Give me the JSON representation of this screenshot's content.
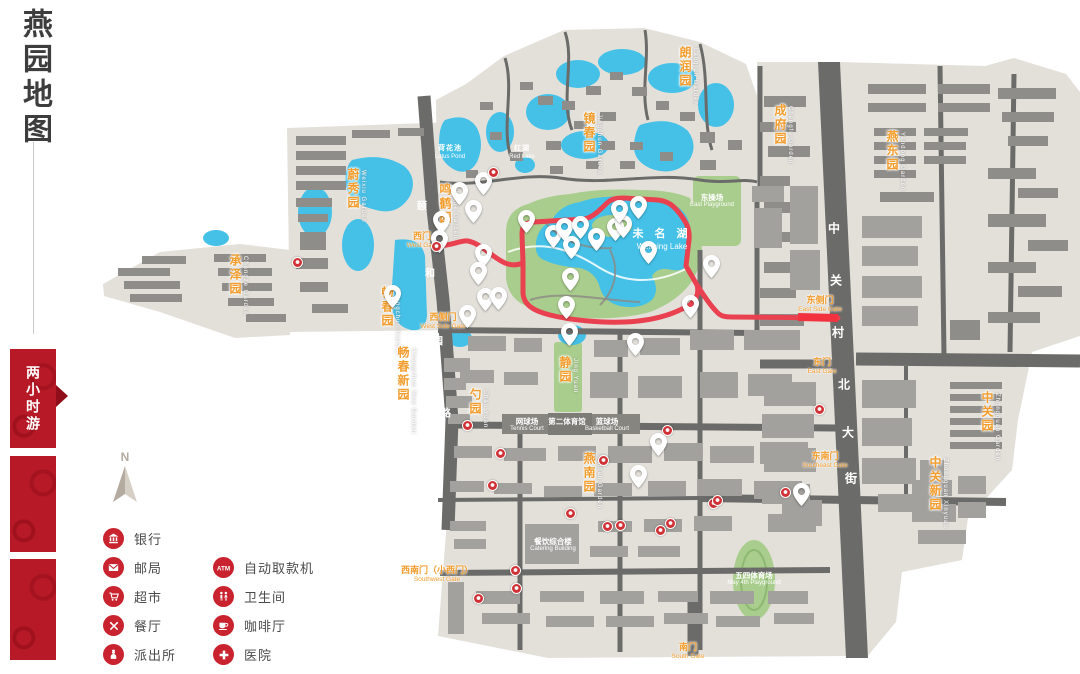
{
  "page": {
    "title": "燕园地图"
  },
  "sidebar": {
    "title": "燕园地图",
    "tour_badge": "两小时游"
  },
  "compass": {
    "label": "N"
  },
  "legend": {
    "column1": [
      {
        "icon": "bank-icon",
        "label": "银行"
      },
      {
        "icon": "post-office-icon",
        "label": "邮局"
      },
      {
        "icon": "supermarket-icon",
        "label": "超市"
      },
      {
        "icon": "restaurant-icon",
        "label": "餐厅"
      },
      {
        "icon": "police-station-icon",
        "label": "派出所"
      }
    ],
    "column2": [
      {
        "icon": "atm-icon",
        "label": "自动取款机"
      },
      {
        "icon": "toilet-icon",
        "label": "卫生间"
      },
      {
        "icon": "cafe-icon",
        "label": "咖啡厅"
      },
      {
        "icon": "hospital-icon",
        "label": "医院"
      }
    ]
  },
  "map": {
    "colors": {
      "base": "#e3e0da",
      "water": "#45c1e8",
      "green": "#a9cd8c",
      "route": "#ea4150",
      "orange": "#f29d2e",
      "road": "#6b6b69",
      "building": "#a3a19d",
      "building_dark": "#8f8d89",
      "legend_red": "#c8232e",
      "sidebar_red": "#b71a26"
    },
    "garden_labels": [
      {
        "text": "蔚秀园",
        "en": "Weixiu Garden",
        "x": 354,
        "y": 168
      },
      {
        "text": "鸣鹤园",
        "en": "Minghe Garden",
        "x": 446,
        "y": 183
      },
      {
        "text": "承泽园",
        "en": "Chengze Garden",
        "x": 236,
        "y": 254
      },
      {
        "text": "畅春园",
        "en": "Changchun Garden",
        "x": 388,
        "y": 286
      },
      {
        "text": "畅春新园",
        "en": "Changchun New Garden",
        "x": 404,
        "y": 346
      },
      {
        "text": "镜春园",
        "en": "Jingchun Garden",
        "x": 590,
        "y": 112
      },
      {
        "text": "朗润园",
        "en": "Langrun Garden",
        "x": 686,
        "y": 46
      },
      {
        "text": "成府园",
        "en": "Chengfu Garden",
        "x": 781,
        "y": 104
      },
      {
        "text": "燕东园",
        "en": "Yandong Garden",
        "x": 893,
        "y": 130
      },
      {
        "text": "中关园",
        "en": "Zhongguan Garden",
        "x": 988,
        "y": 391
      },
      {
        "text": "中关新园",
        "en": "Zhongguan Xinyuan",
        "x": 936,
        "y": 456
      },
      {
        "text": "燕南园",
        "en": "Yannan Garden",
        "x": 590,
        "y": 452
      },
      {
        "text": "静园",
        "en": "Jing Yuan",
        "x": 566,
        "y": 356
      },
      {
        "text": "勺园",
        "en": "Shao Yuan",
        "x": 476,
        "y": 388
      }
    ],
    "gate_labels": [
      {
        "text": "西门",
        "en": "West Gate",
        "x": 422,
        "y": 232
      },
      {
        "text": "西侧门",
        "en": "West Side Gate",
        "x": 443,
        "y": 313
      },
      {
        "text": "西南门（小西门）",
        "en": "Southwest Gate",
        "x": 437,
        "y": 566
      },
      {
        "text": "南门",
        "en": "South Gate",
        "x": 688,
        "y": 643
      },
      {
        "text": "东侧门",
        "en": "East Side Gate",
        "x": 820,
        "y": 296
      },
      {
        "text": "东门",
        "en": "East Gate",
        "x": 822,
        "y": 358
      },
      {
        "text": "东南门",
        "en": "Southeast Gate",
        "x": 825,
        "y": 452
      }
    ],
    "water_labels": [
      {
        "text": "未 名 湖",
        "en": "Weiming  Lake",
        "x": 662,
        "y": 228,
        "size": 11
      },
      {
        "text": "红湖",
        "en": "Red Lake",
        "x": 522,
        "y": 145,
        "size": 7
      },
      {
        "text": "荷花池",
        "en": "Lotus Pond",
        "x": 450,
        "y": 145,
        "size": 7
      }
    ],
    "area_labels": [
      {
        "text": "东操场",
        "en": "East Playground",
        "x": 712,
        "y": 193
      },
      {
        "text": "五四体育场",
        "en": "May 4th Playground",
        "x": 754,
        "y": 571
      },
      {
        "text": "网球场",
        "en": "Tennis Court",
        "x": 527,
        "y": 417
      },
      {
        "text": "第二体育馆",
        "en": "",
        "x": 567,
        "y": 417
      },
      {
        "text": "篮球场",
        "en": "Basketball Court",
        "x": 607,
        "y": 417
      },
      {
        "text": "餐饮综合楼",
        "en": "Catering Building",
        "x": 553,
        "y": 537
      }
    ],
    "street_chars": [
      {
        "ch": "中",
        "x": 834,
        "y": 228
      },
      {
        "ch": "关",
        "x": 836,
        "y": 280
      },
      {
        "ch": "村",
        "x": 838,
        "y": 332
      },
      {
        "ch": "北",
        "x": 844,
        "y": 384
      },
      {
        "ch": "大",
        "x": 848,
        "y": 432
      },
      {
        "ch": "街",
        "x": 851,
        "y": 478
      },
      {
        "ch": "颐",
        "x": 422,
        "y": 205,
        "s": 10
      },
      {
        "ch": "和",
        "x": 430,
        "y": 272,
        "s": 10
      },
      {
        "ch": "园",
        "x": 438,
        "y": 340,
        "s": 10
      },
      {
        "ch": "路",
        "x": 446,
        "y": 412,
        "s": 10
      }
    ],
    "pins": [
      [
        553,
        247
      ],
      [
        564,
        240
      ],
      [
        571,
        258
      ],
      [
        580,
        238
      ],
      [
        596,
        250
      ],
      [
        615,
        240
      ],
      [
        623,
        237
      ],
      [
        638,
        218
      ],
      [
        619,
        222
      ],
      [
        648,
        263
      ],
      [
        570,
        290
      ],
      [
        566,
        318
      ],
      [
        526,
        232
      ],
      [
        483,
        194
      ],
      [
        459,
        204
      ],
      [
        473,
        222
      ],
      [
        441,
        233
      ],
      [
        439,
        252
      ],
      [
        483,
        266
      ],
      [
        478,
        284
      ],
      [
        485,
        310
      ],
      [
        498,
        309
      ],
      [
        467,
        327
      ],
      [
        392,
        307
      ],
      [
        569,
        345
      ],
      [
        635,
        355
      ],
      [
        658,
        455
      ],
      [
        638,
        487
      ],
      [
        690,
        317
      ],
      [
        711,
        277
      ],
      [
        801,
        505
      ]
    ],
    "amenity_dots": [
      [
        436,
        246
      ],
      [
        493,
        172
      ],
      [
        297,
        262
      ],
      [
        467,
        425
      ],
      [
        500,
        453
      ],
      [
        492,
        485
      ],
      [
        603,
        460
      ],
      [
        667,
        430
      ],
      [
        570,
        513
      ],
      [
        607,
        526
      ],
      [
        620,
        525
      ],
      [
        660,
        530
      ],
      [
        670,
        523
      ],
      [
        713,
        503
      ],
      [
        785,
        492
      ],
      [
        515,
        570
      ],
      [
        516,
        588
      ],
      [
        478,
        598
      ],
      [
        819,
        409
      ],
      [
        717,
        500
      ]
    ]
  }
}
